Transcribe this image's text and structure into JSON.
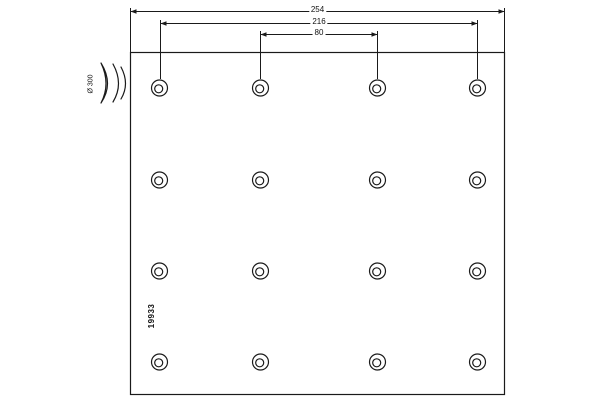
{
  "labels": {
    "dim_total": "254",
    "dim_outer_holes": "216",
    "dim_inner_holes": "80",
    "drum_diameter": "Ø 300",
    "part_number": "19933"
  },
  "colors": {
    "line": "#1a1a1a",
    "background": "#ffffff",
    "text": "#111111"
  },
  "geometry": {
    "canvas": {
      "width": 600,
      "height": 400
    },
    "plate": {
      "x": 130.5,
      "y": 52.5,
      "width": 374,
      "height": 342
    },
    "dim_lines": [
      {
        "y": 11.5,
        "x1": 130.5,
        "x2": 504.5
      },
      {
        "y": 23.5,
        "x1": 160.5,
        "x2": 477.5
      },
      {
        "y": 34.5,
        "x1": 260.5,
        "x2": 377.5
      }
    ],
    "dim_label_positions": [
      {
        "x": 317.5,
        "y": 10
      },
      {
        "x": 319,
        "y": 22
      },
      {
        "x": 319,
        "y": 33
      }
    ],
    "extension_lines": [
      {
        "x": 130.5,
        "y1": 8,
        "y2": 52
      },
      {
        "x": 504.5,
        "y1": 8,
        "y2": 52
      },
      {
        "x": 160.5,
        "y1": 20,
        "y2": 79
      },
      {
        "x": 477.5,
        "y1": 20,
        "y2": 79
      },
      {
        "x": 260.5,
        "y1": 31,
        "y2": 79
      },
      {
        "x": 377.5,
        "y1": 31,
        "y2": 79
      }
    ],
    "holes": {
      "cols_x": [
        159.5,
        260.5,
        377.5,
        477.5
      ],
      "rows_y": [
        88,
        180,
        271,
        362
      ],
      "outer_radius": 8,
      "inner_radius": 4,
      "inner_offset": {
        "dx": -0.8,
        "dy": 0.8
      }
    },
    "curvature_symbol": {
      "crescent": "M101,63 Q114,84 101,103 Q111,84 101,63 Z",
      "arcs": [
        "M113,64 Q124,84 113,102",
        "M121,67 Q130,84 121,99"
      ]
    },
    "drum_label_pos": {
      "x": 91,
      "y": 84
    },
    "part_number_pos": {
      "x": 152,
      "y": 316
    }
  }
}
